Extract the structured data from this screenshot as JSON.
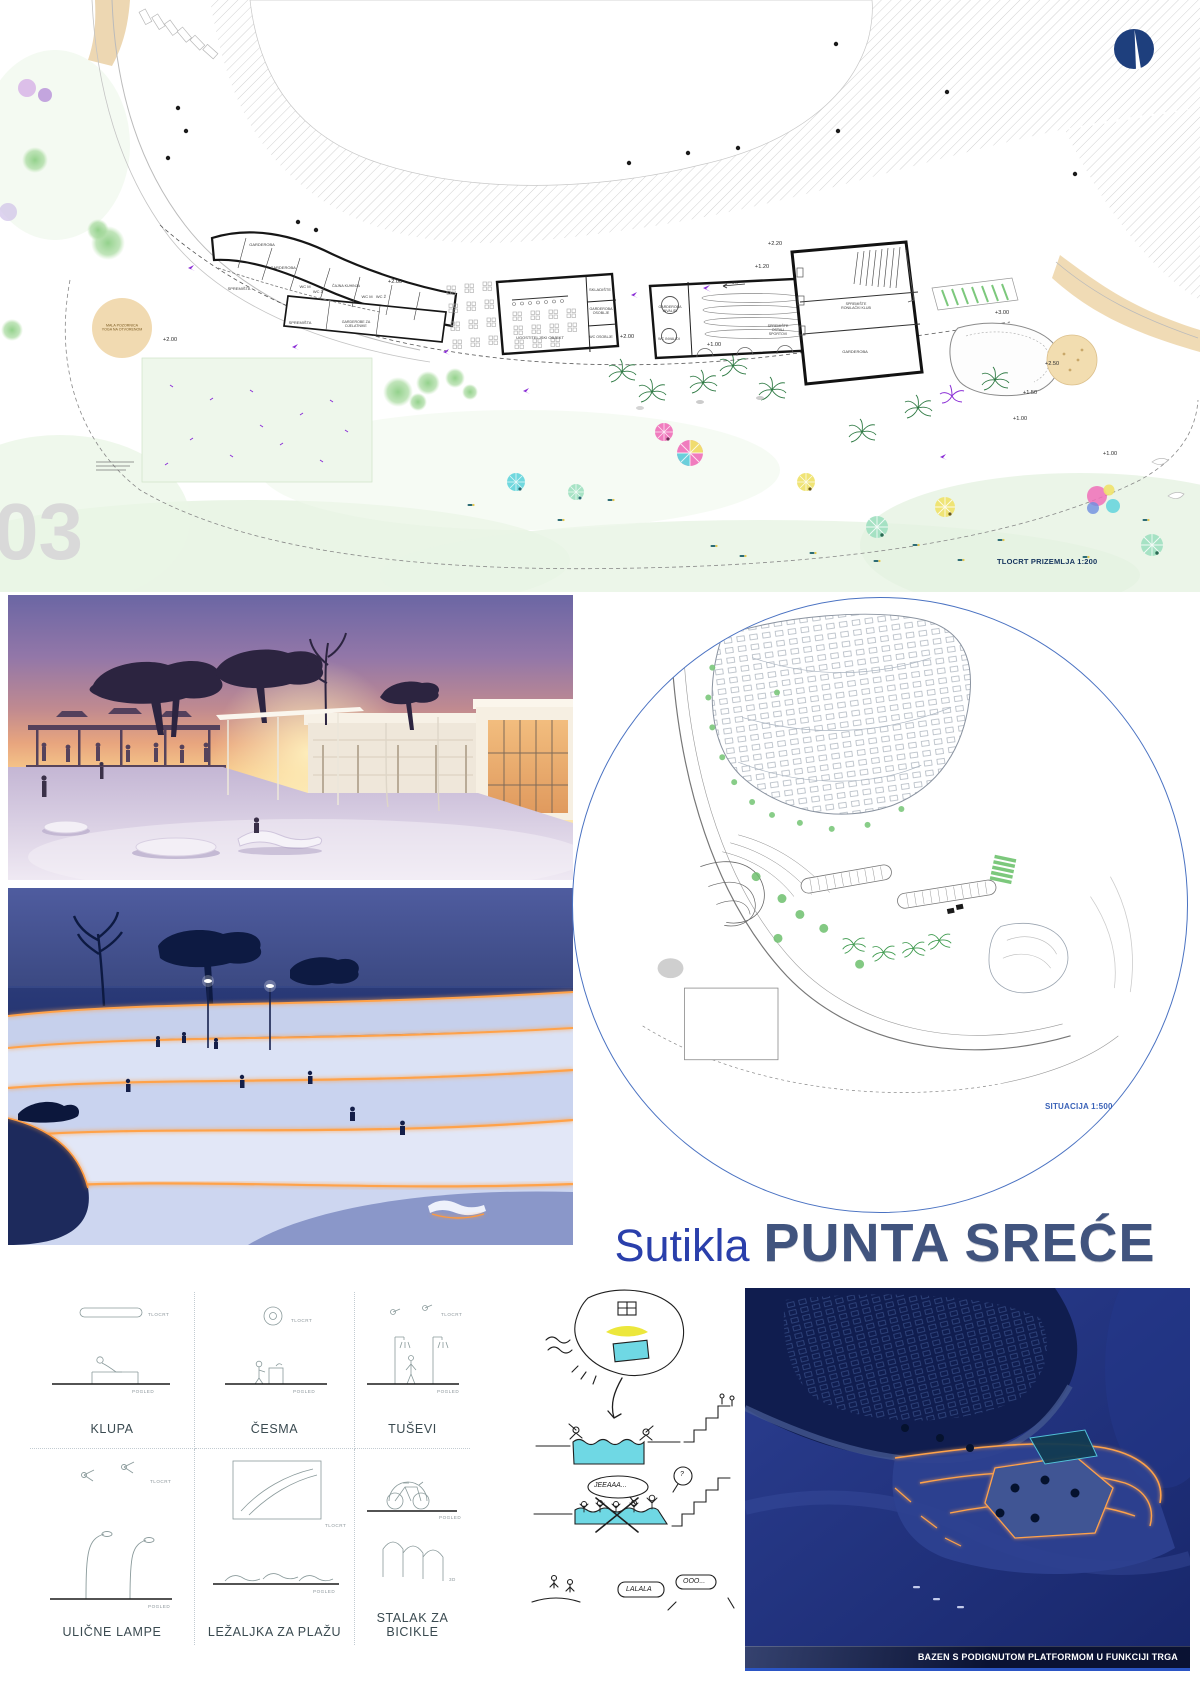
{
  "plan": {
    "watermark": "03",
    "scale_label": "TLOCRT PRIZEMLJA 1:200",
    "stage_line1": "MALA POZORNICA",
    "stage_line2": "YOGA NA OTVORENOM",
    "ramp_label": "5%",
    "rooms": {
      "b1_garderoba_a": "GARDEROBA",
      "b1_garderoba_b": "GARDEROBA",
      "b1_spremista_a": "SPREMIŠTA",
      "b1_wc_m_a": "WC M",
      "b1_wc_z_a": "WC Ž",
      "b1_cajna_kuhinja": "ČAJNA KUHINJA",
      "b1_wc_m_b": "WC M",
      "b1_wc_z_b": "WC Ž",
      "b1_spremista_b": "SPREMIŠTA",
      "b1_garderobe_djelatnici": "GARDEROBE ZA DJELATNIKE",
      "b2_ugostiteljski": "UGOSTITELJSKI OBJEKT",
      "b2_skladiste": "SKLADIŠTE",
      "b2_garderoba_osoblje": "GARDEROBA OSOBLJE",
      "b2_wc_osoblje": "WC OSOBLJE",
      "b3_garderoba_invalidi": "GARDEROBA INVALIDI",
      "b3_wc_invalidi": "WC INVALIDI",
      "b3_spremiste_sportovi": "SPREMIŠTE OSTALI SPORTOVI",
      "b4_spremiste_ronilacki": "SPREMIŠTE RONILAČKI KLUB",
      "b4_garderoba": "GARDEROBA"
    },
    "levels": {
      "l1": "+2.00",
      "l2": "+2.00",
      "l3": "+2.00",
      "l4": "+1.00",
      "l5": "+1.20",
      "l6": "+2.20",
      "l7": "+3.00",
      "l8": "+2.50",
      "l9": "+1.50",
      "l10": "+1.00",
      "l11": "+1.00"
    }
  },
  "situation": {
    "label": "SITUACIJA 1:500"
  },
  "title": {
    "prefix": "Sutikla",
    "main": "PUNTA SREĆE"
  },
  "furniture": {
    "tag_plan": "TLOCRT",
    "tag_view": "POGLED",
    "tag_3d": "3D",
    "items": [
      {
        "label": "KLUPA"
      },
      {
        "label": "ČESMA"
      },
      {
        "label": "TUŠEVI"
      },
      {
        "label": "ULIČNE LAMPE"
      },
      {
        "label": "LEŽALJKA ZA PLAŽU"
      },
      {
        "label": "STALAK ZA BICIKLE"
      }
    ]
  },
  "sketch": {
    "bubble_yeah": "JEEAAA...",
    "bubble_q": "?",
    "bubble_lalala": "LALALA",
    "bubble_ooo": "OOO..."
  },
  "aerial": {
    "caption": "BAZEN S PODIGNUTOM PLATFORMOM U FUNKCIJI TRGA"
  },
  "colors": {
    "title_blue": "#2a3fab",
    "title_navy": "#41547e",
    "circle_blue": "#4a72c2",
    "glow_orange": "#ff9a3e",
    "logo_navy": "#1e3f7d"
  }
}
